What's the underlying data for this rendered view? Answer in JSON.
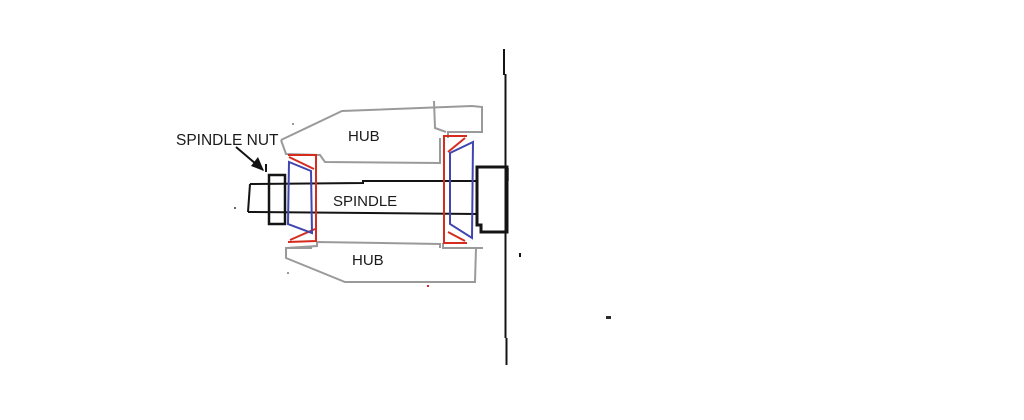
{
  "canvas": {
    "width": 1024,
    "height": 420,
    "background": "#ffffff"
  },
  "palette": {
    "ink": "#141414",
    "hub": "#9a9a9a",
    "cup": "#d62c20",
    "cone": "#3f46b0",
    "text": "#1a1a1a"
  },
  "labels": {
    "spindle_nut": "SPINDLE NUT",
    "hub_top": "HUB",
    "spindle": "SPINDLE",
    "hub_bottom": "HUB"
  },
  "texts": [
    {
      "name": "label-spindle-nut",
      "bind": "spindle_nut",
      "x": 176,
      "y": 145,
      "size": 15.5
    },
    {
      "name": "label-hub-top",
      "bind": "hub_top",
      "x": 348,
      "y": 141,
      "size": 15
    },
    {
      "name": "label-spindle",
      "bind": "spindle",
      "x": 333,
      "y": 206,
      "size": 15
    },
    {
      "name": "label-hub-bottom",
      "bind": "hub_bottom",
      "x": 352,
      "y": 265,
      "size": 15
    }
  ],
  "shapes": [
    {
      "name": "hub-top-outline",
      "type": "polyline",
      "stroke": "hub",
      "w": 2,
      "pts": [
        [
          281,
          140
        ],
        [
          342,
          111
        ],
        [
          472,
          106
        ],
        [
          482,
          107
        ],
        [
          482,
          132
        ],
        [
          448,
          132
        ],
        [
          448,
          138
        ]
      ]
    },
    {
      "name": "hub-top-bore-line",
      "type": "polyline",
      "stroke": "hub",
      "w": 2,
      "pts": [
        [
          281,
          140
        ],
        [
          286,
          154
        ],
        [
          320,
          155
        ],
        [
          325,
          162
        ],
        [
          440,
          163
        ],
        [
          440,
          138
        ]
      ]
    },
    {
      "name": "hub-top-web-line",
      "type": "polyline",
      "stroke": "hub",
      "w": 2,
      "pts": [
        [
          434,
          101
        ],
        [
          435,
          128
        ],
        [
          446,
          132
        ]
      ]
    },
    {
      "name": "hub-bottom-outline",
      "type": "polyline",
      "stroke": "hub",
      "w": 2,
      "pts": [
        [
          312,
          248
        ],
        [
          286,
          248
        ],
        [
          286,
          258
        ],
        [
          345,
          282
        ],
        [
          475,
          282
        ],
        [
          476,
          248
        ]
      ]
    },
    {
      "name": "hub-bottom-seat-line",
      "type": "polyline",
      "stroke": "hub",
      "w": 2,
      "pts": [
        [
          286,
          248
        ],
        [
          317,
          246
        ],
        [
          317,
          242
        ],
        [
          440,
          244
        ],
        [
          440,
          248
        ]
      ]
    },
    {
      "name": "hub-bottom-right-line",
      "type": "polyline",
      "stroke": "hub",
      "w": 2,
      "pts": [
        [
          443,
          243
        ],
        [
          443,
          248
        ],
        [
          483,
          248
        ]
      ]
    },
    {
      "name": "block-gray-stub",
      "type": "line",
      "stroke": "hub",
      "w": 2,
      "pts": [
        [
          508,
          168
        ],
        [
          508,
          181
        ]
      ]
    },
    {
      "name": "spindle-top-line",
      "type": "polyline",
      "stroke": "ink",
      "w": 2,
      "pts": [
        [
          250,
          184
        ],
        [
          363,
          183
        ],
        [
          363,
          181
        ],
        [
          477,
          181
        ]
      ]
    },
    {
      "name": "spindle-bottom-line",
      "type": "line",
      "stroke": "ink",
      "w": 2,
      "pts": [
        [
          248,
          212
        ],
        [
          477,
          214
        ]
      ]
    },
    {
      "name": "spindle-end-line",
      "type": "line",
      "stroke": "ink",
      "w": 2,
      "pts": [
        [
          250,
          184
        ],
        [
          248,
          212
        ]
      ]
    },
    {
      "name": "spindle-nut-outline",
      "type": "rect",
      "stroke": "ink",
      "w": 2.5,
      "x": 269,
      "y": 175,
      "width": 16,
      "height": 49
    },
    {
      "name": "arrow-line",
      "type": "line",
      "stroke": "ink",
      "w": 2,
      "pts": [
        [
          236,
          147
        ],
        [
          263,
          170
        ]
      ]
    },
    {
      "name": "arrow-head",
      "type": "polygon",
      "fill": "ink",
      "pts": [
        [
          264,
          171
        ],
        [
          251,
          166
        ],
        [
          258,
          157
        ]
      ]
    },
    {
      "name": "arrow-tick",
      "type": "line",
      "stroke": "ink",
      "w": 2,
      "pts": [
        [
          266,
          164
        ],
        [
          266,
          172
        ]
      ]
    },
    {
      "name": "outer-block-outline",
      "type": "polygon",
      "stroke": "ink",
      "w": 3,
      "pts": [
        [
          477,
          167
        ],
        [
          507,
          167
        ],
        [
          507,
          232
        ],
        [
          481,
          232
        ],
        [
          481,
          225
        ],
        [
          477,
          225
        ]
      ]
    },
    {
      "name": "vertical-line-upper",
      "type": "line",
      "stroke": "ink",
      "w": 2,
      "pts": [
        [
          504,
          49
        ],
        [
          504,
          75
        ]
      ]
    },
    {
      "name": "vertical-line-middle",
      "type": "line",
      "stroke": "ink",
      "w": 2,
      "pts": [
        [
          505.5,
          74
        ],
        [
          505.5,
          338
        ]
      ]
    },
    {
      "name": "vertical-line-lower",
      "type": "line",
      "stroke": "ink",
      "w": 2,
      "pts": [
        [
          506.5,
          338
        ],
        [
          506.5,
          365
        ]
      ]
    },
    {
      "name": "left-bearing-cup",
      "type": "polyline",
      "stroke": "cup",
      "w": 2,
      "pts": [
        [
          288,
          155
        ],
        [
          316,
          155
        ],
        [
          316,
          241
        ],
        [
          288,
          242
        ]
      ]
    },
    {
      "name": "left-cup-top-diagonal",
      "type": "line",
      "stroke": "cup",
      "w": 2,
      "pts": [
        [
          289,
          157
        ],
        [
          314,
          169
        ]
      ]
    },
    {
      "name": "left-cup-bottom-diagonal",
      "type": "line",
      "stroke": "cup",
      "w": 2,
      "pts": [
        [
          290,
          240
        ],
        [
          315,
          229
        ]
      ]
    },
    {
      "name": "right-bearing-cup",
      "type": "polyline",
      "stroke": "cup",
      "w": 2,
      "pts": [
        [
          467,
          136
        ],
        [
          444,
          136
        ],
        [
          444,
          243
        ],
        [
          467,
          243
        ]
      ]
    },
    {
      "name": "right-cup-top-diagonal",
      "type": "line",
      "stroke": "cup",
      "w": 2,
      "pts": [
        [
          465,
          138
        ],
        [
          448,
          152
        ]
      ]
    },
    {
      "name": "right-cup-bottom-diagonal",
      "type": "line",
      "stroke": "cup",
      "w": 2,
      "pts": [
        [
          448,
          232
        ],
        [
          465,
          241
        ]
      ]
    },
    {
      "name": "left-bearing-cone",
      "type": "polygon",
      "stroke": "cone",
      "w": 2,
      "pts": [
        [
          289,
          162
        ],
        [
          311,
          171
        ],
        [
          312,
          233
        ],
        [
          288,
          224
        ]
      ]
    },
    {
      "name": "right-bearing-cone",
      "type": "polygon",
      "stroke": "cone",
      "w": 2,
      "pts": [
        [
          473,
          142
        ],
        [
          450,
          153
        ],
        [
          450,
          224
        ],
        [
          472,
          238
        ]
      ]
    },
    {
      "name": "speck-left-of-spindle",
      "type": "rect",
      "fill": "#666666",
      "x": 234,
      "y": 207,
      "width": 2,
      "height": 2
    },
    {
      "name": "speck-above-hub",
      "type": "rect",
      "fill": "#9a9a9a",
      "x": 292,
      "y": 123,
      "width": 2,
      "height": 2
    },
    {
      "name": "speck-below-hub",
      "type": "rect",
      "fill": "#9a9a9a",
      "x": 287,
      "y": 272,
      "width": 2,
      "height": 2
    },
    {
      "name": "speck-red",
      "type": "rect",
      "fill": "#d62c20",
      "x": 427,
      "y": 285,
      "width": 2,
      "height": 2
    },
    {
      "name": "speck-right-of-line",
      "type": "rect",
      "fill": "#141414",
      "x": 519,
      "y": 253,
      "width": 2,
      "height": 4
    },
    {
      "name": "speck-far-right",
      "type": "rect",
      "fill": "#2a2a2a",
      "x": 606,
      "y": 316,
      "width": 5,
      "height": 3
    }
  ]
}
